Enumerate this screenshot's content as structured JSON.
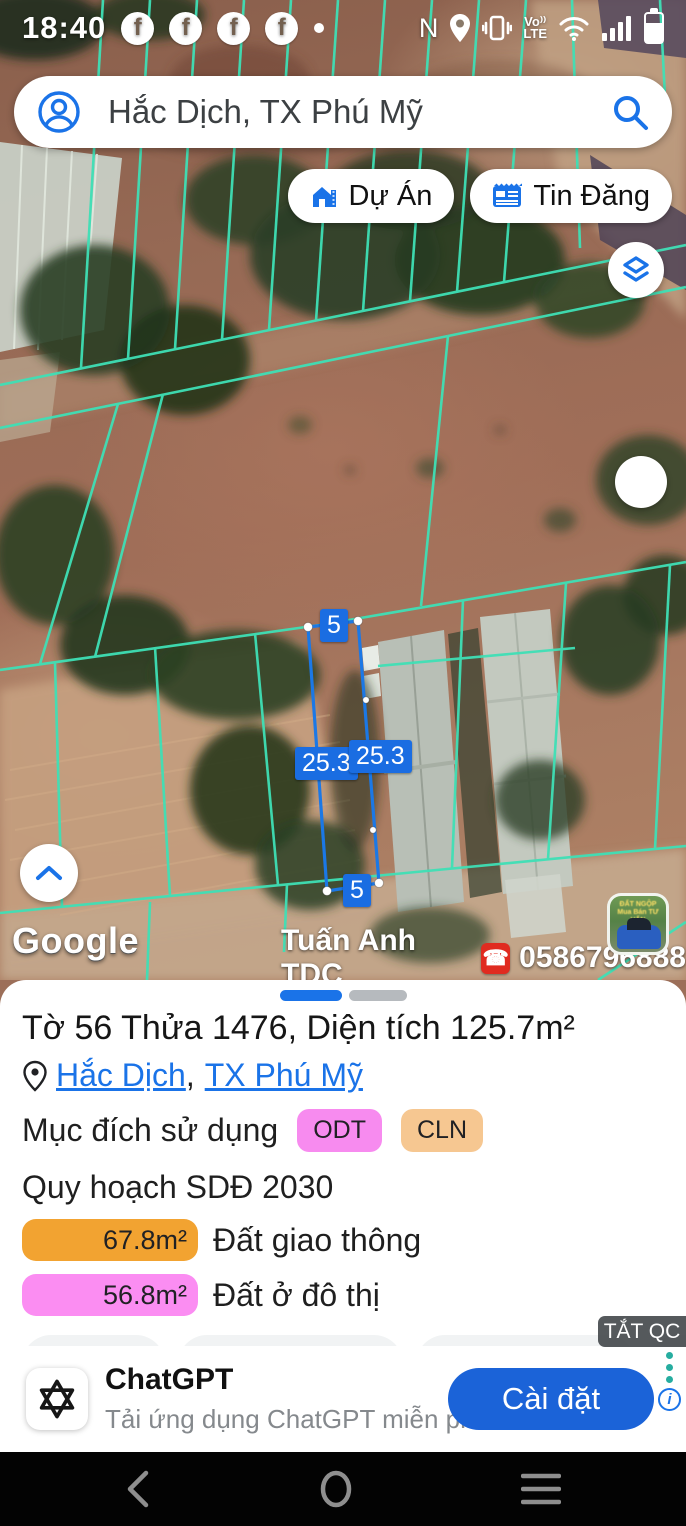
{
  "status_bar": {
    "time": "18:40",
    "nfc": "N",
    "volte_line1": "Vo",
    "volte_line2": "LTE"
  },
  "search": {
    "query": "Hắc Dịch, TX Phú Mỹ"
  },
  "map_chips": {
    "projects": "Dự Án",
    "listings": "Tin Đăng"
  },
  "map": {
    "measurements": {
      "top": "5",
      "left": "25.3",
      "right": "25.3",
      "bottom": "5"
    },
    "watermark": "Google",
    "contact": {
      "name": "Tuấn Anh TDC",
      "phone_icon": "☎",
      "phone": "0586796888"
    },
    "colors": {
      "parcel_grid": "#3fe0b6",
      "selected_parcel": "#1b78e6",
      "measure_label_bg": "#1a6de2"
    }
  },
  "panel": {
    "title": "Tờ 56 Thửa 1476, Diện tích 125.7m²",
    "location": {
      "ward": "Hắc Dịch",
      "separator": ",",
      "town": "TX Phú Mỹ"
    },
    "purpose": {
      "label": "Mục đích sử dụng",
      "badges": [
        {
          "code": "ODT",
          "color": "#f78bef"
        },
        {
          "code": "CLN",
          "color": "#f6c791"
        }
      ]
    },
    "plan_label": "Quy hoạch SDĐ 2030",
    "zones": [
      {
        "area": "67.8m²",
        "label": "Đất giao thông",
        "color": "#f2a331"
      },
      {
        "area": "56.8m²",
        "label": "Đất ở đô thị",
        "color": "#fb8df2"
      }
    ],
    "actions": [
      {
        "label": "Lưu"
      },
      {
        "label": "Đăng bán"
      },
      {
        "label": "Chú thích"
      }
    ],
    "ad_dismiss": "TẮT QC",
    "ad": {
      "app_name": "ChatGPT",
      "description": "Tải ứng dụng ChatGPT miễn phí và có...",
      "install": "Cài đặt"
    }
  }
}
